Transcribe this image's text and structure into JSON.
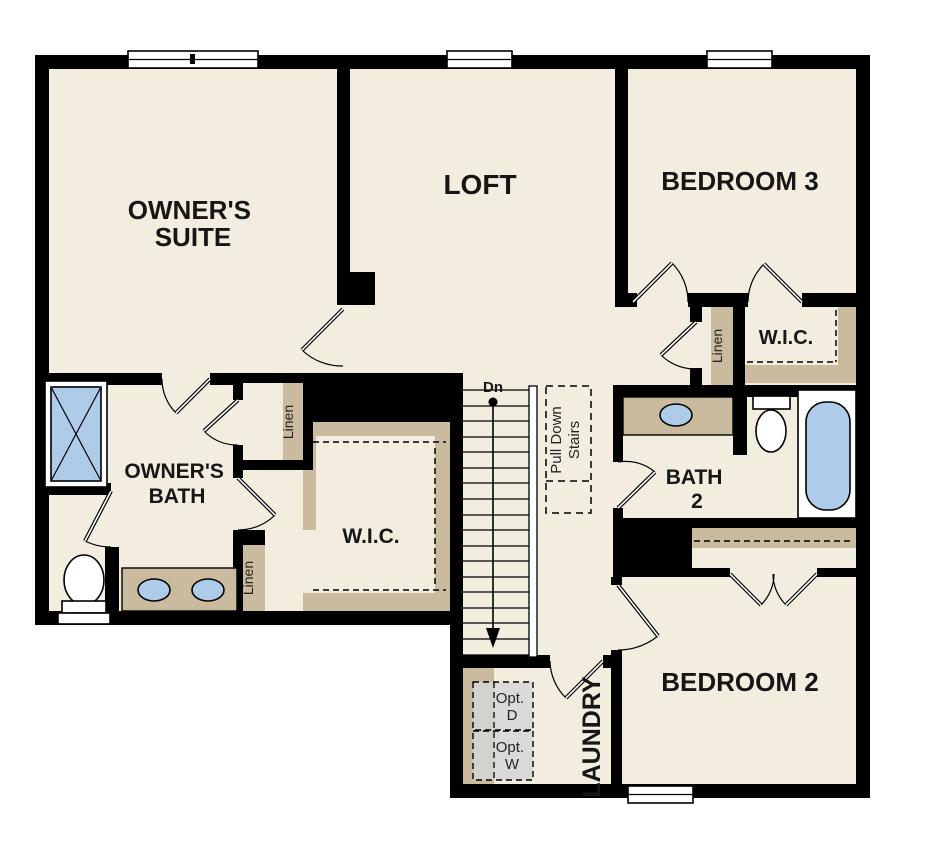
{
  "plan": {
    "type": "floor-plan",
    "floor": "second-floor"
  },
  "colors": {
    "walls": "#000000",
    "floor": "#f3ede0",
    "casework_tan": "#cabb9e",
    "fixture_blue": "#aecbea",
    "appliance_gray": "#d9d9d9",
    "background": "#ffffff"
  },
  "rooms": {
    "owners_suite": {
      "label": "OWNER'S SUITE",
      "lines": [
        "OWNER'S",
        "SUITE"
      ]
    },
    "loft": {
      "label": "LOFT"
    },
    "bedroom3": {
      "label": "BEDROOM 3"
    },
    "bedroom3_wic": {
      "label": "W.I.C."
    },
    "owners_bath": {
      "label": "OWNER'S BATH",
      "lines": [
        "OWNER'S",
        "BATH"
      ]
    },
    "owners_wic": {
      "label": "W.I.C."
    },
    "bath2": {
      "label": "BATH 2",
      "lines": [
        "BATH",
        "2"
      ]
    },
    "bedroom2": {
      "label": "BEDROOM 2"
    },
    "laundry": {
      "label": "LAUNDRY"
    }
  },
  "closets": {
    "bedroom3_linen": {
      "label": "Linen"
    },
    "bath_linen_upper": {
      "label": "Linen"
    },
    "bath_linen_lower": {
      "label": "Linen"
    }
  },
  "stairs": {
    "direction_label": "Dn",
    "pull_down_label": "Pull Down Stairs",
    "pull_down_lines": [
      "Pull Down",
      "Stairs"
    ]
  },
  "appliances": {
    "optional_dryer": {
      "label": "Opt. D",
      "lines": [
        "Opt.",
        "D"
      ]
    },
    "optional_washer": {
      "label": "Opt. W",
      "lines": [
        "Opt.",
        "W"
      ]
    }
  }
}
